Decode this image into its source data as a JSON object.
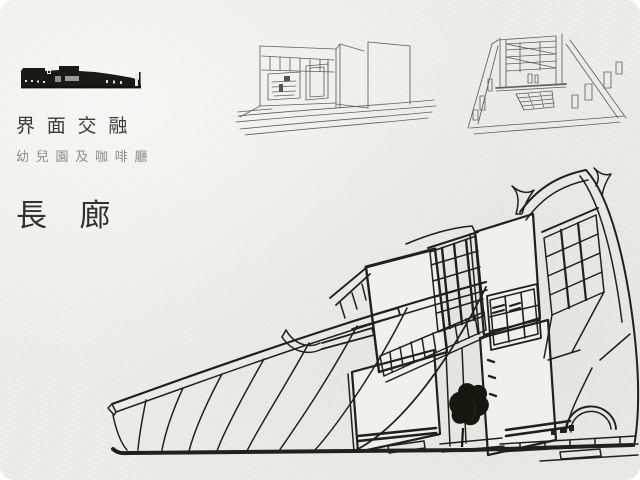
{
  "slide": {
    "title": "界面交融",
    "subtitle": "幼兒園及咖啡廳",
    "section_title": "長廊",
    "colors": {
      "background": "#ecede7",
      "ink": "#21211c",
      "pencil_line": "#61615a",
      "title_text": "#3b3b36",
      "subtitle_text": "#8c8c85",
      "section_text": "#31312d",
      "logo_black": "#191915",
      "logo_gray": "#a9a9a3"
    },
    "logo": "building-silhouette",
    "images": {
      "left_sketch": "corridor-perspective-sketch",
      "right_sketch": "atrium-staircase-sketch",
      "main_drawing": "building-axonometric-line-drawing"
    }
  }
}
